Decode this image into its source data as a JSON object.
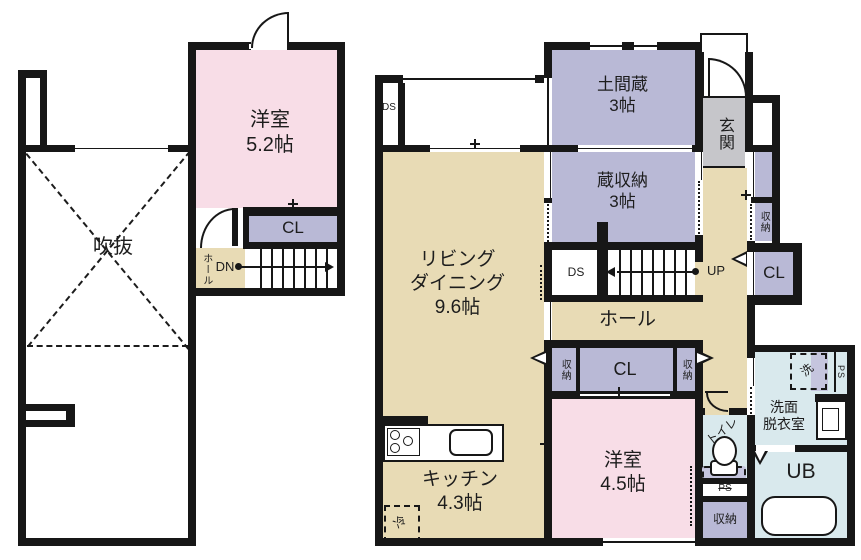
{
  "palette": {
    "wall": "#171717",
    "tan": "#e8dbb5",
    "pink": "#f8dde7",
    "purple": "#b9b9d6",
    "blue": "#d9e9ed",
    "gray": "#c6c6ca",
    "lavender": "#c5c5de",
    "paper": "#ffffff"
  },
  "floor2": {
    "room": {
      "name": "洋室",
      "size": "5.2帖"
    },
    "fukinuke": "吹抜",
    "cl": "CL",
    "hall": "ホール",
    "dn": "DN"
  },
  "floor1": {
    "doma": {
      "name": "土間蔵",
      "size": "3帖"
    },
    "kura": {
      "name": "蔵収納",
      "size": "3帖"
    },
    "genkan": "玄関",
    "ds_top": "DS",
    "ds_stair": "DS",
    "up": "UP",
    "living": {
      "line1": "リビング",
      "line2": "ダイニング",
      "size": "9.6帖"
    },
    "hall": "ホール",
    "kitchen": {
      "name": "キッチン",
      "size": "4.3帖"
    },
    "room": {
      "name": "洋室",
      "size": "4.5帖"
    },
    "cl_mid": "CL",
    "cl_right": "CL",
    "shuno_row_left": "収納",
    "shuno_row_right": "収納",
    "shuno_col": "収納",
    "shuno_bottom": "収納",
    "toilet": "トイレ",
    "ps_toilet": "PS",
    "ps_bath": "PS",
    "senmen": {
      "line1": "洗面",
      "line2": "脱衣室"
    },
    "wash": "洗",
    "fridge": "冷",
    "ub": "UB"
  }
}
